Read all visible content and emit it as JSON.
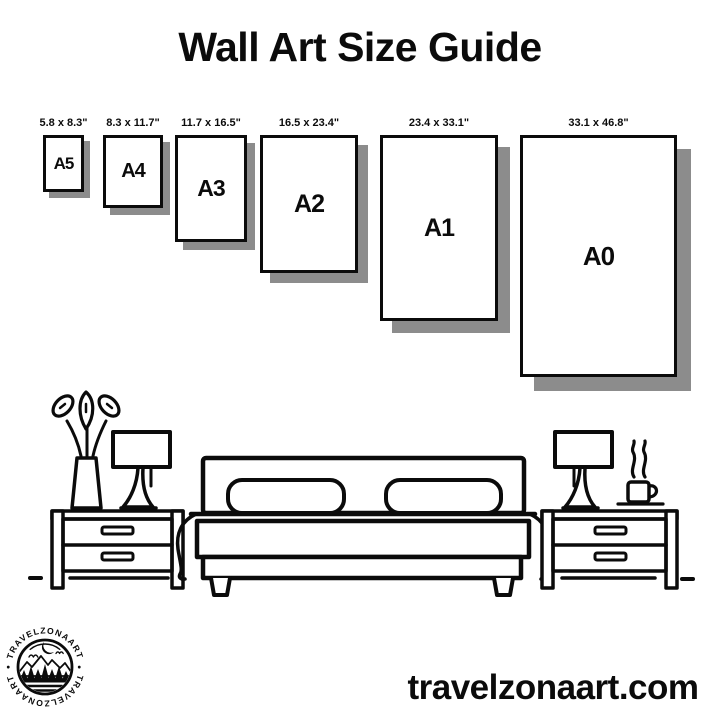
{
  "title": "Wall Art Size Guide",
  "sizes": [
    {
      "name": "A5",
      "dimensions": "5.8 x 8.3\""
    },
    {
      "name": "A4",
      "dimensions": "8.3 x 11.7\""
    },
    {
      "name": "A3",
      "dimensions": "11.7 x 16.5\""
    },
    {
      "name": "A2",
      "dimensions": "16.5 x 23.4\""
    },
    {
      "name": "A1",
      "dimensions": "23.4 x 33.1\""
    },
    {
      "name": "A0",
      "dimensions": "33.1 x 46.8\""
    }
  ],
  "logo": {
    "brand": "TRAVELZONAART",
    "separator": "•"
  },
  "footer": {
    "website": "travelzonaart.com"
  },
  "colors": {
    "ink": "#0b0b0b",
    "shadow": "#8c8c8c",
    "background": "#ffffff"
  }
}
